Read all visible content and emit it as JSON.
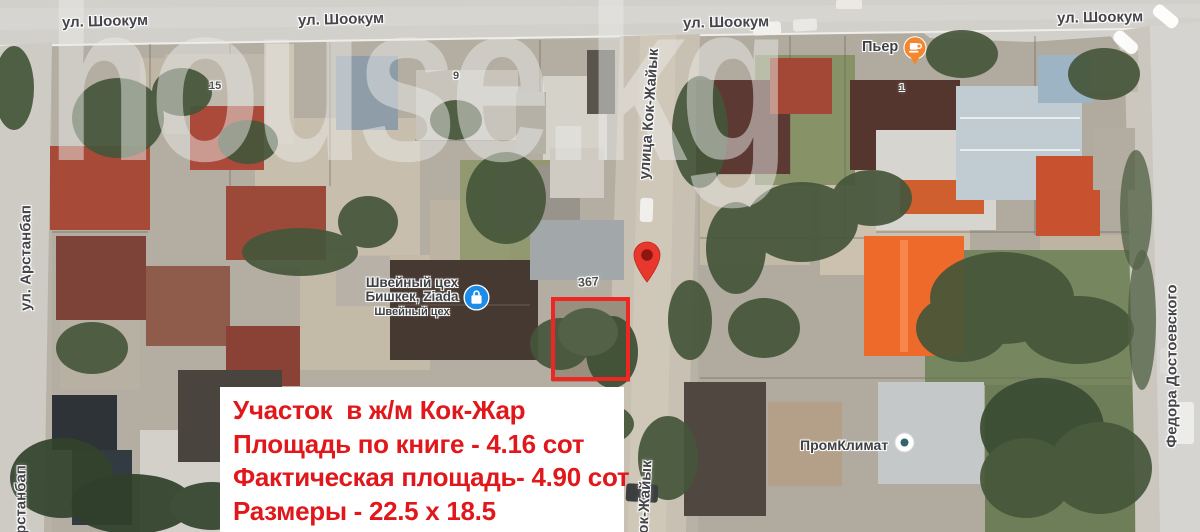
{
  "map": {
    "watermark": "house.kg",
    "street_labels": {
      "shookum_1": "ул. Шоокум",
      "shookum_2": "ул. Шоокум",
      "shookum_3": "ул. Шоокум",
      "shookum_4": "ул. Шоокум",
      "arstanbap_full": "ул. Арстанбап",
      "arstanbap_short": "Арстанбап",
      "kok_zhaiyk_full": "улица Кок-Жайык",
      "kok_zhaiyk_short": "ок-Жайык",
      "dostoevskogo": "Федора Достоевского"
    },
    "house_numbers": {
      "n15": "15",
      "n9": "9",
      "n367": "367",
      "n1": "1"
    },
    "pois": {
      "sewing": {
        "line1": "Швейный цех",
        "line2": "Бишкек, Ziada",
        "line3": "Швейный цех",
        "icon": "shopping-bag-icon"
      },
      "pier": {
        "label": "Пьер",
        "icon": "cafe-icon"
      },
      "promklimat": {
        "label": "ПромКлимат",
        "icon": "place-dot-icon"
      }
    },
    "colors": {
      "marker": "#e8382d",
      "marker_dot": "#8d1710",
      "parcel_outline": "#ee2722",
      "poi_blue": "#1c8ce8",
      "poi_orange": "#f4872e",
      "poi_dot": "#33646b"
    }
  },
  "info_box": {
    "line1": "Участок  в ж/м Кок-Жар",
    "line2": "Площадь по книге - 4.16 сот",
    "line3": "Фактическая площадь- 4.90 сот",
    "line4": "Размеры - 22.5 x 18.5",
    "text_color": "#e1181b",
    "background": "#ffffff"
  }
}
